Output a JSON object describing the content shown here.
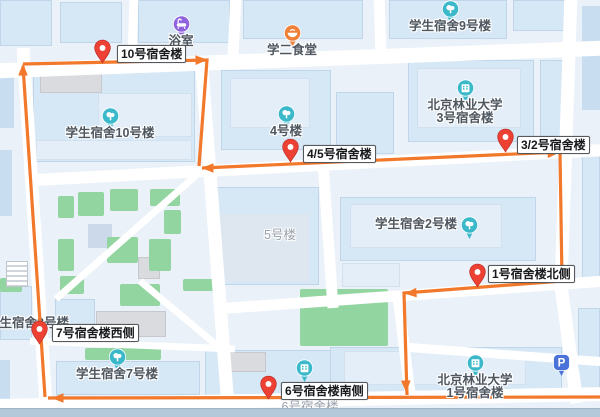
{
  "title": "校园宿舍楼巡查路线地图",
  "colors": {
    "route_orange": "#f2782b",
    "pin_red": "#ed4134",
    "poi_teal": "#3bb9ca",
    "poi_purple": "#8f63de",
    "poi_food_orange": "#f08038",
    "parking_blue": "#4a72d9",
    "road_white": "#ffffff",
    "building_blue": "#d6e7f6",
    "green_area": "#93d5a0"
  },
  "map": {
    "route": {
      "color": "#f2782b",
      "segments": [
        {
          "points": "45,397 23,66"
        },
        {
          "points": "23,64 207,60 199,166"
        },
        {
          "points": "202,168 560,152 562,280"
        },
        {
          "points": "562,281 404,293 407,395"
        },
        {
          "points": "610,397 48,398"
        }
      ],
      "arrows": [
        {
          "x": 23,
          "y": 70,
          "angle": -90
        },
        {
          "x": 201,
          "y": 60,
          "angle": -2
        },
        {
          "x": 208,
          "y": 168,
          "angle": 180
        },
        {
          "x": 553,
          "y": 153,
          "angle": -4
        },
        {
          "x": 562,
          "y": 271,
          "angle": 90
        },
        {
          "x": 411,
          "y": 293,
          "angle": 176
        },
        {
          "x": 406,
          "y": 386,
          "angle": 88
        },
        {
          "x": 58,
          "y": 398,
          "angle": 180
        }
      ]
    },
    "checkpoints": [
      {
        "label": "10号宿舍楼",
        "tip": [
          102,
          64
        ],
        "box": [
          117,
          45
        ]
      },
      {
        "label": "4/5号宿舍楼",
        "tip": [
          290,
          163
        ],
        "box": [
          303,
          145
        ]
      },
      {
        "label": "3/2号宿舍楼",
        "tip": [
          505,
          153
        ],
        "box": [
          517,
          136
        ]
      },
      {
        "label": "1号宿舍楼北侧",
        "tip": [
          477,
          288
        ],
        "box": [
          488,
          265
        ]
      },
      {
        "label": "7号宿舍楼西侧",
        "tip": [
          39,
          345
        ],
        "box": [
          52,
          324
        ]
      },
      {
        "label": "6号宿舍楼南侧",
        "tip": [
          268,
          400
        ],
        "box": [
          281,
          382
        ]
      }
    ],
    "pois": [
      {
        "name": "浴室",
        "icon": "bath",
        "color": "#8f63de",
        "cx": 181,
        "cy": 24,
        "side": "center"
      },
      {
        "name": "学二食堂",
        "icon": "food",
        "color": "#f08038",
        "cx": 292,
        "cy": 33,
        "side": "center"
      },
      {
        "name": "学生宿舍9号楼",
        "icon": "tree",
        "color": "#3bb9ca",
        "cx": 450,
        "cy": 9,
        "side": "center"
      },
      {
        "name": "北京林业大学",
        "name2": "3号宿舍楼",
        "icon": "building",
        "color": "#3bb9ca",
        "cx": 465,
        "cy": 88,
        "side": "center"
      },
      {
        "name": "4号楼",
        "icon": "tree",
        "color": "#3bb9ca",
        "cx": 286,
        "cy": 114,
        "side": "center"
      },
      {
        "name": "学生宿舍10号楼",
        "icon": "tree",
        "color": "#3bb9ca",
        "cx": 110,
        "cy": 116,
        "side": "center"
      },
      {
        "name": "学生宿舍2号楼",
        "icon": "tree",
        "color": "#3bb9ca",
        "cx": 469,
        "cy": 225,
        "side": "left"
      },
      {
        "name": "学生宿舍7号楼",
        "icon": "tree",
        "color": "#3bb9ca",
        "cx": 117,
        "cy": 357,
        "side": "center"
      },
      {
        "name": "",
        "icon": "building",
        "color": "#3bb9ca",
        "cx": 304,
        "cy": 368,
        "side": "none"
      },
      {
        "name": "北京林业大学",
        "name2": "1号宿舍楼",
        "icon": "building",
        "color": "#3bb9ca",
        "cx": 475,
        "cy": 363,
        "side": "center"
      },
      {
        "name": "P",
        "icon": "parking",
        "color": "#4a72d9",
        "cx": 561,
        "cy": 362,
        "side": "none"
      }
    ],
    "street_labels": [
      {
        "text": "5号楼",
        "x": 280,
        "y": 229,
        "tone": "muted"
      },
      {
        "text": "学生宿舍8号楼",
        "x": 28,
        "y": 317,
        "tone": "dark"
      },
      {
        "text": "6号宿舍楼",
        "x": 310,
        "y": 401,
        "tone": "muted"
      }
    ]
  }
}
